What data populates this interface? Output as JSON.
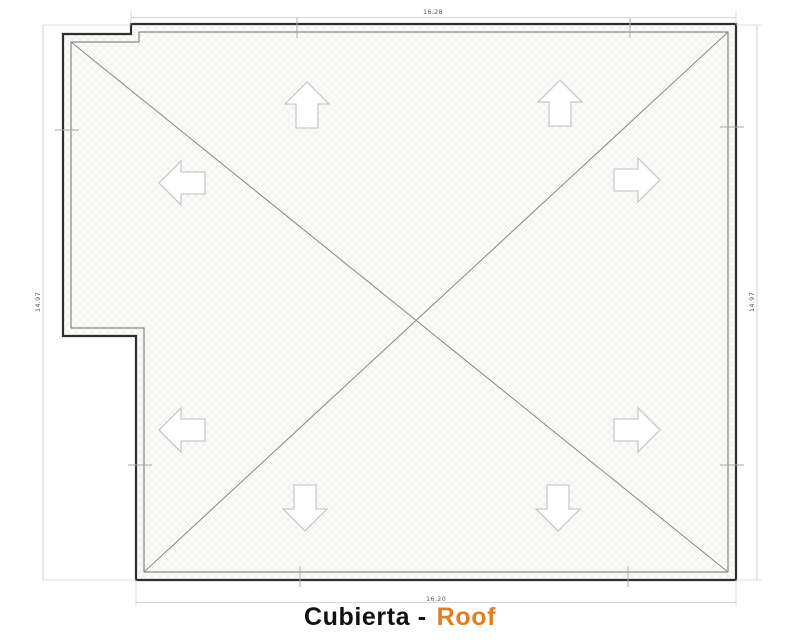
{
  "plan": {
    "dimensions": {
      "top": "16.28",
      "bottom": "16.20",
      "left": "14.97",
      "right": "14.97"
    },
    "slope_arrows": [
      {
        "direction": "up"
      },
      {
        "direction": "up"
      },
      {
        "direction": "left"
      },
      {
        "direction": "right"
      },
      {
        "direction": "left"
      },
      {
        "direction": "right"
      },
      {
        "direction": "down"
      },
      {
        "direction": "down"
      }
    ],
    "colors": {
      "wall_outline": "#2E2E2E",
      "inner_wall": "#707070",
      "hip_line": "#8F8F8F",
      "dimension_line": "#C7C7C7",
      "dimension_text": "#5A5A5A",
      "arrow_outline": "#C9C9C9",
      "roof_fill": "#FBFBFA",
      "hatch": "#F0F0EE"
    }
  },
  "title": {
    "main": "Cubierta -",
    "accent": "Roof",
    "accent_color": "#E87B1E"
  }
}
